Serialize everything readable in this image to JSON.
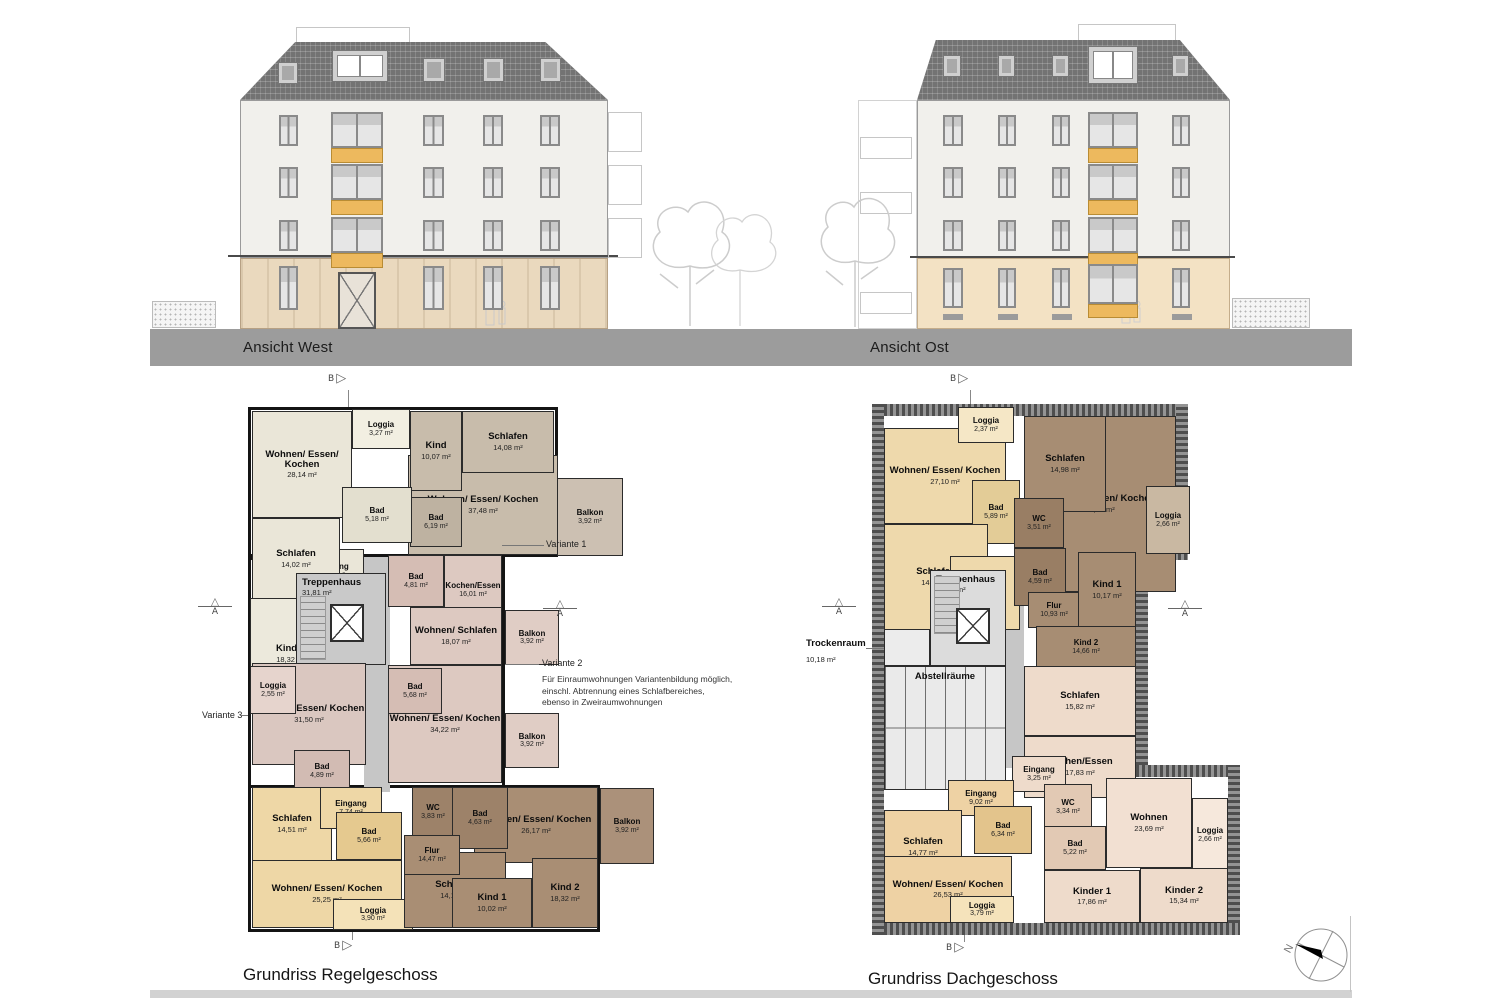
{
  "elevations": {
    "west": {
      "label": "Ansicht West"
    },
    "ost": {
      "label": "Ansicht Ost"
    }
  },
  "markers": {
    "a": "A",
    "b": "B",
    "north": "N"
  },
  "icons": {
    "triangle_right": "▷",
    "triangle_up": "△"
  },
  "palette": {
    "road_gray": "#9c9c9c",
    "accent_orange": "#edb95e",
    "roof_gray": "#737373",
    "apt_cream": "#eae6d8",
    "apt_taupe": "#c8bcab",
    "apt_pink": "#ddc9c1",
    "apt_mauve": "#dac7c0",
    "apt_tan": "#eed7a6",
    "apt_brown": "#a98e74",
    "core_gray": "#c9c9c9"
  },
  "plans": [
    {
      "title": "Grundriss Regelgeschoss",
      "annotations": {
        "variante1": "Variante 1",
        "variante2_title": "Variante 2",
        "variante2_l1": "Für Einraumwohnungen Variantenbildung möglich,",
        "variante2_l2": "einschl. Abtrennung eines Schlafbereiches,",
        "variante2_l3": "ebenso in Zweiraumwohnungen",
        "variante3": "Variante 3"
      },
      "rooms": [
        {
          "name": "Wohnen/ Essen/ Kochen",
          "area": "28,14 m²"
        },
        {
          "name": "Loggia",
          "area": "3,27 m²"
        },
        {
          "name": "Wohnen/ Essen/ Kochen",
          "area": "37,48 m²"
        },
        {
          "name": "Kind",
          "area": "10,07 m²"
        },
        {
          "name": "Schlafen",
          "area": "14,08 m²"
        },
        {
          "name": "Bad",
          "area": "6,19 m²"
        },
        {
          "name": "Bad",
          "area": "5,18 m²"
        },
        {
          "name": "Eingang",
          "area": "8,18 m²"
        },
        {
          "name": "Schlafen",
          "area": "14,02 m²"
        },
        {
          "name": "Kinder",
          "area": "18,32 m²"
        },
        {
          "name": "Treppenhaus",
          "area": "31,81 m²"
        },
        {
          "name": "Balkon",
          "area": "3,92 m²"
        },
        {
          "name": "Bad",
          "area": "4,81 m²"
        },
        {
          "name": "Kochen/Essen",
          "area": "16,01 m²"
        },
        {
          "name": "Wohnen/ Schlafen",
          "area": "18,07 m²"
        },
        {
          "name": "Balkon",
          "area": "3,92 m²"
        },
        {
          "name": "Wohnen/ Essen/ Kochen",
          "area": "34,22 m²"
        },
        {
          "name": "Bad",
          "area": "5,68 m²"
        },
        {
          "name": "Balkon",
          "area": "3,92 m²"
        },
        {
          "name": "Wohnen/ Essen/ Kochen",
          "area": "31,50 m²"
        },
        {
          "name": "Loggia",
          "area": "2,55 m²"
        },
        {
          "name": "Bad",
          "area": "4,89 m²"
        },
        {
          "name": "Schlafen",
          "area": "14,51 m²"
        },
        {
          "name": "Eingang",
          "area": "7,74 m²"
        },
        {
          "name": "Bad",
          "area": "5,66 m²"
        },
        {
          "name": "Wohnen/ Essen/ Kochen",
          "area": "25,25 m²"
        },
        {
          "name": "Loggia",
          "area": "3,90 m²"
        },
        {
          "name": "Wohnen/ Essen/ Kochen",
          "area": "26,17 m²"
        },
        {
          "name": "WC",
          "area": "3,83 m²"
        },
        {
          "name": "Bad",
          "area": "4,63 m²"
        },
        {
          "name": "Schlafen",
          "area": "14,17 m²"
        },
        {
          "name": "Flur",
          "area": "14,47 m²"
        },
        {
          "name": "Kind 1",
          "area": "10,02 m²"
        },
        {
          "name": "Kind 2",
          "area": "18,32 m²"
        },
        {
          "name": "Balkon",
          "area": "3,92 m²"
        }
      ]
    },
    {
      "title": "Grundriss Dachgeschoss",
      "trockenraum": {
        "name": "Trockenraum",
        "area": "10,18 m²"
      },
      "rooms": [
        {
          "name": "Wohnen/ Essen/ Kochen",
          "area": "27,10 m²"
        },
        {
          "name": "Loggia",
          "area": "2,37 m²"
        },
        {
          "name": "Bad",
          "area": "5,89 m²"
        },
        {
          "name": "Schlafen",
          "area": "14,94 m²"
        },
        {
          "name": "Eingang",
          "area": "8,18 m²"
        },
        {
          "name": "Wohnen/ Essen/ Kochen",
          "area": "30,66 m²"
        },
        {
          "name": "Schlafen",
          "area": "14,98 m²"
        },
        {
          "name": "WC",
          "area": "3,51 m²"
        },
        {
          "name": "Bad",
          "area": "4,59 m²"
        },
        {
          "name": "Loggia",
          "area": "2,66 m²"
        },
        {
          "name": "Flur",
          "area": "10,93 m²"
        },
        {
          "name": "Kind 1",
          "area": "10,17 m²"
        },
        {
          "name": "Kind 2",
          "area": "14,66 m²"
        },
        {
          "name": "Treppenhaus",
          "area": "25,63 m²"
        },
        {
          "name": "Abstellräume",
          "area": ""
        },
        {
          "name": "Schlafen",
          "area": "15,82 m²"
        },
        {
          "name": "Kochen/Essen",
          "area": "17,83 m²"
        },
        {
          "name": "Eingang",
          "area": "3,25 m²"
        },
        {
          "name": "WC",
          "area": "3,34 m²"
        },
        {
          "name": "Bad",
          "area": "5,22 m²"
        },
        {
          "name": "Wohnen",
          "area": "23,69 m²"
        },
        {
          "name": "Loggia",
          "area": "2,66 m²"
        },
        {
          "name": "Kinder 1",
          "area": "17,86 m²"
        },
        {
          "name": "Kinder 2",
          "area": "15,34 m²"
        },
        {
          "name": "Eingang",
          "area": "9,02 m²"
        },
        {
          "name": "Schlafen",
          "area": "14,77 m²"
        },
        {
          "name": "Bad",
          "area": "6,34 m²"
        },
        {
          "name": "Wohnen/ Essen/ Kochen",
          "area": "26,53 m²"
        },
        {
          "name": "Loggia",
          "area": "3,79 m²"
        }
      ]
    }
  ]
}
